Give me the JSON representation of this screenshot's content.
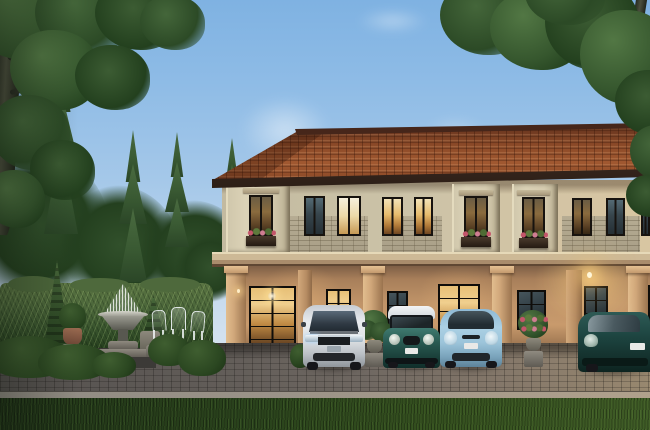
{
  "scene": {
    "description": "Dusk 3D architectural rendering: a row of two-storey Mediterranean-style townhouses with terracotta tile roof, cream stucco and brick facade, warm-lit glass doors and windows with flower boxes; four cars parked on a cobblestone driveway; formal garden at left with tall hedge, topiary, classical fountain and white bistro chairs; tall spruces and overhanging deciduous trees against a clear evening sky; mown lawn strip in the foreground",
    "time_of_day": "dusk",
    "counts": {
      "cars": 4,
      "floors": 2,
      "upper_windows": 10,
      "flower_boxes": 3
    },
    "palette": {
      "sky_top": "#7fb2e2",
      "sky_horizon": "#dde7f0",
      "roof_tile": "#8c4a28",
      "roof_ridge": "#46261a",
      "fascia": "#38261c",
      "stucco_upper": "#ccc3a8",
      "brick": "#b0a68d",
      "cornice": "#cdb996",
      "ground_wall": "#bf9368",
      "column": "#d0a77a",
      "window_frame": "#17130f",
      "window_glow_warm": "#e6bb6d",
      "window_cool": "#37454c",
      "door_glow": "#f0cf8e",
      "lamp_glow": "#ffd98a",
      "hedge_green": "#4b663a",
      "conifer_green": "#2c4a26",
      "lawn_green": "#2a431c",
      "cobblestone": "#6e6761",
      "curb_stone": "#9b9388",
      "fountain_stone": "#8f8a80",
      "car_white": "#e8ebee",
      "car_mini_teal": "#2a5a52",
      "car_mini_roof": "#eceef0",
      "car_light_blue": "#a9cfe4",
      "car_dark_teal": "#1e4642",
      "flower_pink": "#c4556a",
      "flower_red": "#c43f2e"
    },
    "objects": [
      {
        "label": "White minivan parked facing forward"
      },
      {
        "label": "Dark teal compact car with white roof"
      },
      {
        "label": "Light blue hatchback"
      },
      {
        "label": "Dark teal hatchback at far right"
      },
      {
        "label": "Classical garden fountain with water spray"
      },
      {
        "label": "White garden bistro chairs against hedge"
      },
      {
        "label": "Tall clipped hedge wall"
      },
      {
        "label": "Tall spruce trees"
      },
      {
        "label": "Overhanging deciduous tree, top left"
      },
      {
        "label": "Overhanging deciduous tree, top right"
      },
      {
        "label": "Two-storey townhouse row with terracotta roof"
      },
      {
        "label": "Glowing pendant porch lamp"
      },
      {
        "label": "Potted fern on stone pedestal"
      },
      {
        "label": "Potted red flowers on stone pedestal"
      },
      {
        "label": "Cobblestone driveway"
      },
      {
        "label": "Foreground lawn strip"
      },
      {
        "label": "Spiral topiary tree"
      }
    ]
  }
}
